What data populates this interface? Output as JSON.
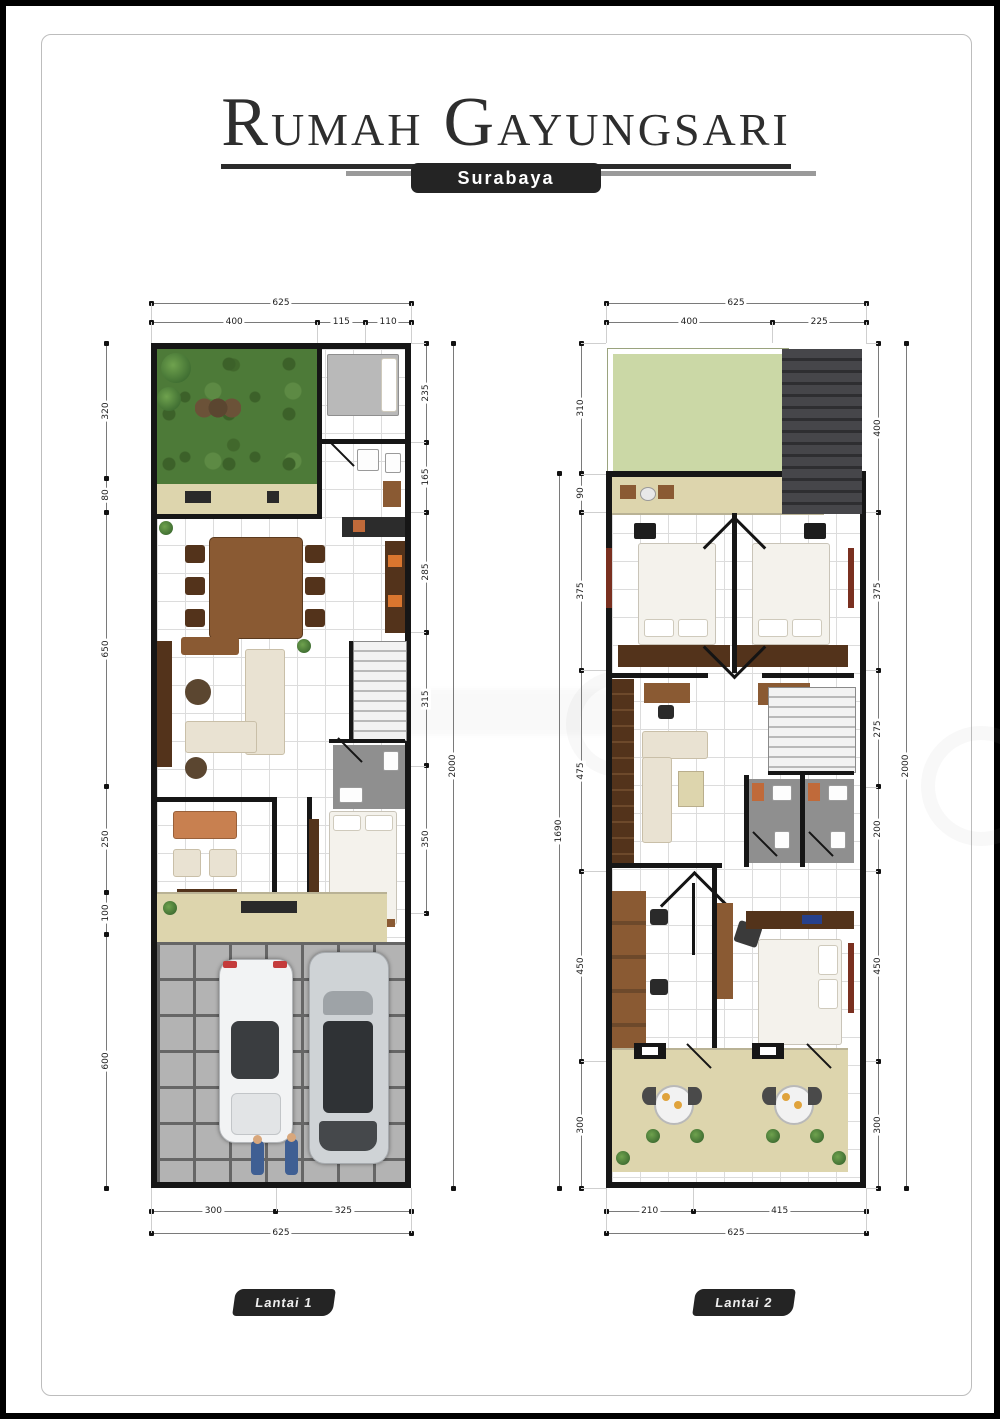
{
  "header": {
    "title_words": [
      "Rumah",
      "Gayungsari"
    ],
    "subtitle": "Surabaya"
  },
  "palette": {
    "wall": "#161616",
    "title": "#2e2e2e",
    "badge": "#242424",
    "grass": "#4d7a38",
    "grassdark": "#3c6129",
    "roofgreen": "#cbd8a6",
    "beige": "#ddd5ad",
    "paver": "#b3b3b3",
    "paverline": "#666666",
    "floorgrid": "#dcdcdc",
    "wood": "#8a5a33",
    "wooddark": "#53331b",
    "cream": "#e9e2d2",
    "bathfloor": "#8f8f8f"
  },
  "plans": [
    {
      "id": "lantai1",
      "label": "Lantai 1",
      "dims": {
        "top_total": "625",
        "top_segments": [
          "400",
          "115",
          "110"
        ],
        "bottom_segments": [
          "300",
          "325"
        ],
        "bottom_total": "625",
        "v_chains": [
          {
            "name": "left",
            "start": 0,
            "segments": [
              "320",
              "80",
              "650",
              "250",
              "100",
              "600"
            ]
          },
          {
            "name": "right_inner",
            "start": 0,
            "segments": [
              "235",
              "165",
              "285",
              "315",
              "350"
            ]
          },
          {
            "name": "right_total",
            "start": 0,
            "segments": [
              "2000"
            ]
          }
        ]
      }
    },
    {
      "id": "lantai2",
      "label": "Lantai 2",
      "dims": {
        "top_total": "625",
        "top_segments": [
          "400",
          "225"
        ],
        "bottom_segments": [
          "210",
          "415"
        ],
        "bottom_total": "625",
        "v_chains": [
          {
            "name": "left_total",
            "start": 310,
            "segments": [
              "1690"
            ]
          },
          {
            "name": "left_inner",
            "start": 0,
            "segments": [
              "310",
              "90",
              "375",
              "475",
              "450",
              "300"
            ]
          },
          {
            "name": "right_inner",
            "start": 0,
            "segments": [
              "400",
              "375",
              "275",
              "200",
              "450",
              "300"
            ]
          },
          {
            "name": "right_total",
            "start": 0,
            "segments": [
              "2000"
            ]
          }
        ]
      }
    }
  ]
}
